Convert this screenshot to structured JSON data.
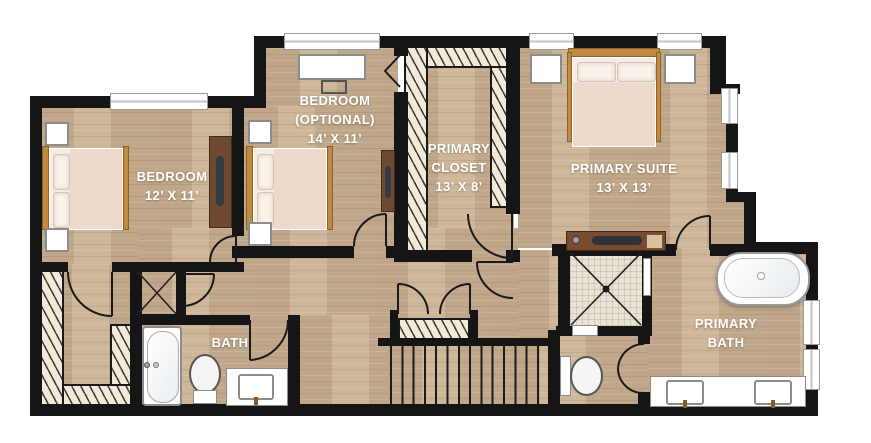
{
  "rooms": {
    "bedroom_left": {
      "name": "BEDROOM",
      "dims": "12’ X 11’"
    },
    "bedroom_optional": {
      "name": "BEDROOM",
      "qualifier": "(OPTIONAL)",
      "dims": "14’ X 11’"
    },
    "primary_closet": {
      "name_line1": "PRIMARY",
      "name_line2": "CLOSET",
      "dims": "13’ X 8’"
    },
    "primary_suite": {
      "name": "PRIMARY SUITE",
      "dims": "13’ X 13’"
    },
    "bath": {
      "name": "BATH"
    },
    "primary_bath": {
      "name_line1": "PRIMARY",
      "name_line2": "BATH"
    }
  },
  "palette": {
    "background": "#ffffff",
    "wall": "#151515",
    "floor_wood": "#c9b193",
    "closet_hatch": "#f2e9d9",
    "shower_tile": "#e9e3d5",
    "fixture_white": "#ffffff",
    "furniture_wood": "#c08a44",
    "dark_wood": "#6e4a33",
    "mattress": "#f2e0d6",
    "label_text": "#ffffff"
  },
  "fixtures": [
    "bed",
    "pillow",
    "nightstand",
    "dresser",
    "desk",
    "chair",
    "window",
    "bathtub",
    "freestanding-tub",
    "toilet",
    "vanity-sink",
    "walk-in-shower",
    "stairs",
    "closet-rods",
    "attic-access",
    "door-swing",
    "bifold-door"
  ]
}
